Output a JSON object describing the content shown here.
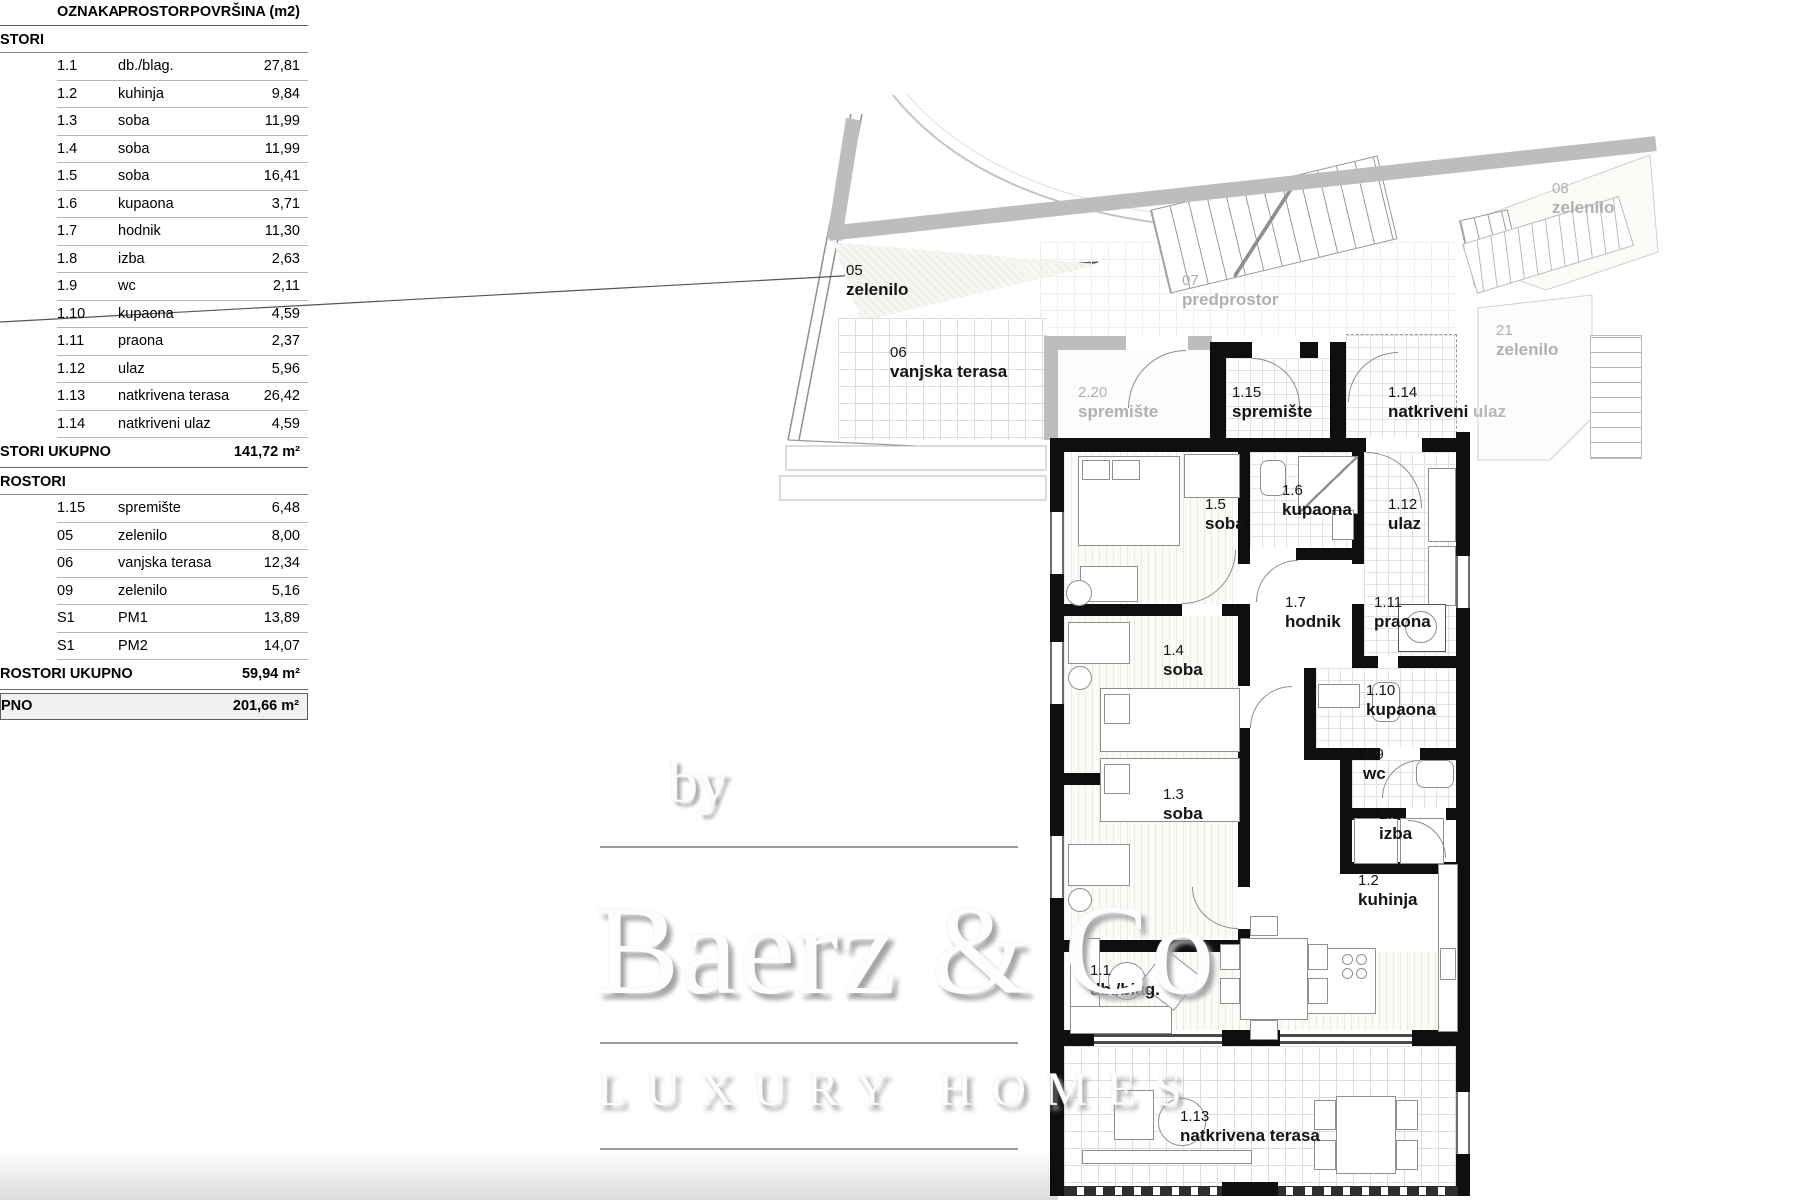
{
  "table": {
    "headers": {
      "oznaka": "OZNAKA",
      "prostor": "PROSTOR",
      "povrsina": "POVRŠINA (m2)"
    },
    "section1": {
      "title": "STORI",
      "rows": [
        {
          "oznaka": "1.1",
          "prostor": "db./blag.",
          "povrsina": "27,81"
        },
        {
          "oznaka": "1.2",
          "prostor": "kuhinja",
          "povrsina": "9,84"
        },
        {
          "oznaka": "1.3",
          "prostor": "soba",
          "povrsina": "11,99"
        },
        {
          "oznaka": "1.4",
          "prostor": "soba",
          "povrsina": "11,99"
        },
        {
          "oznaka": "1.5",
          "prostor": "soba",
          "povrsina": "16,41"
        },
        {
          "oznaka": "1.6",
          "prostor": "kupaona",
          "povrsina": "3,71"
        },
        {
          "oznaka": "1.7",
          "prostor": "hodnik",
          "povrsina": "11,30"
        },
        {
          "oznaka": "1.8",
          "prostor": "izba",
          "povrsina": "2,63"
        },
        {
          "oznaka": "1.9",
          "prostor": "wc",
          "povrsina": "2,11"
        },
        {
          "oznaka": "1.10",
          "prostor": "kupaona",
          "povrsina": "4,59"
        },
        {
          "oznaka": "1.11",
          "prostor": "praona",
          "povrsina": "2,37"
        },
        {
          "oznaka": "1.12",
          "prostor": "ulaz",
          "povrsina": "5,96"
        },
        {
          "oznaka": "1.13",
          "prostor": "natkrivena terasa",
          "povrsina": "26,42"
        },
        {
          "oznaka": "1.14",
          "prostor": "natkriveni ulaz",
          "povrsina": "4,59"
        }
      ],
      "total_label": "STORI UKUPNO",
      "total_value": "141,72 m²"
    },
    "section2": {
      "title": "ROSTORI",
      "rows": [
        {
          "oznaka": "1.15",
          "prostor": "spremište",
          "povrsina": "6,48"
        },
        {
          "oznaka": "05",
          "prostor": "zelenilo",
          "povrsina": "8,00"
        },
        {
          "oznaka": "06",
          "prostor": "vanjska terasa",
          "povrsina": "12,34"
        },
        {
          "oznaka": "09",
          "prostor": "zelenilo",
          "povrsina": "5,16"
        },
        {
          "oznaka": "S1",
          "prostor": "PM1",
          "povrsina": "13,89"
        },
        {
          "oznaka": "S1",
          "prostor": "PM2",
          "povrsina": "14,07"
        }
      ],
      "total_label": "ROSTORI UKUPNO",
      "total_value": "59,94 m²"
    },
    "grand_total": {
      "label": "PNO",
      "value": "201,66 m²"
    }
  },
  "plan": {
    "rooms": {
      "z05": {
        "code": "05",
        "name": "zelenilo"
      },
      "z06": {
        "code": "06",
        "name": "vanjska terasa"
      },
      "z07": {
        "code": "07",
        "name": "predprostor"
      },
      "z08": {
        "code": "08",
        "name": "zelenilo"
      },
      "z21": {
        "code": "21",
        "name": "zelenilo"
      },
      "s220": {
        "code": "2.20",
        "name": "spremište"
      },
      "r115": {
        "code": "1.15",
        "name": "spremište"
      },
      "r114": {
        "code": "1.14",
        "name": "natkriveni",
        "name2": " ulaz"
      },
      "r15": {
        "code": "1.5",
        "name": "soba"
      },
      "r16": {
        "code": "1.6",
        "name": "kupaona"
      },
      "r112": {
        "code": "1.12",
        "name": "ulaz"
      },
      "r17": {
        "code": "1.7",
        "name": "hodnik"
      },
      "r111": {
        "code": "1.11",
        "name": "praona"
      },
      "r14": {
        "code": "1.4",
        "name": "soba"
      },
      "r110": {
        "code": "1.10",
        "name": "kupaona"
      },
      "r19": {
        "code": "1.9",
        "name": "wc"
      },
      "r18": {
        "code": "1.8",
        "name": "izba"
      },
      "r13": {
        "code": "1.3",
        "name": "soba"
      },
      "r12": {
        "code": "1.2",
        "name": "kuhinja"
      },
      "r11": {
        "code": "1.1",
        "name": "db./blag."
      },
      "r113": {
        "code": "1.13",
        "name": "natkrivena terasa"
      }
    }
  },
  "watermark": {
    "by": "by",
    "brand": "Baerz & Co",
    "tagline": "LUXURY HOMES"
  },
  "colors": {
    "wall": "#0f0f0f",
    "gray_wall": "#bdbdbd",
    "gray_label": "#b0b0b0",
    "grand_total_bg": "#f1f1f1"
  }
}
